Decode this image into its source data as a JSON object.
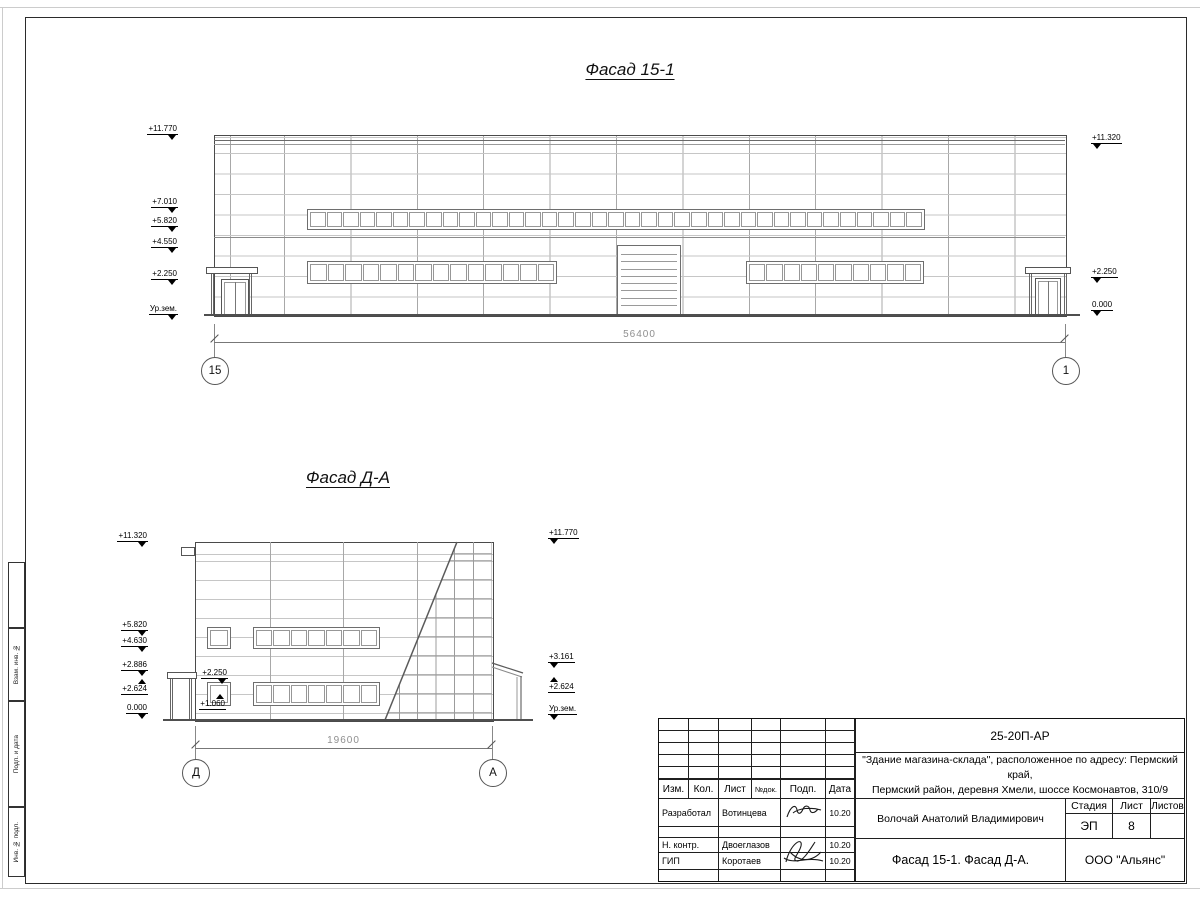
{
  "drawing": {
    "facade1": {
      "title": "Фасад 15-1",
      "dimension": "56400",
      "axis_left": "15",
      "axis_right": "1",
      "elevations_left": [
        "+11.770",
        "+7.010",
        "+5.820",
        "+4.550",
        "+2.250",
        "Ур.зем."
      ],
      "elevations_right": [
        "+11.320",
        "+2.250",
        "0.000"
      ],
      "bands": {
        "upper_panes": 37,
        "lower_left_panes": 14,
        "lower_right_panes": 10
      },
      "gate_slats": 9
    },
    "facade2": {
      "title": "Фасад Д-А",
      "dimension": "19600",
      "axis_left": "Д",
      "axis_right": "А",
      "elevations_left": [
        "+11.320",
        "+5.820",
        "+4.630",
        "+2.886",
        "+2.624",
        "0.000"
      ],
      "elevations_right": [
        "+11.770",
        "+3.161",
        "+2.624",
        "Ур.зем."
      ],
      "window_marks": [
        "+2.250",
        "+1.060"
      ],
      "bands": {
        "middle_panes": 7,
        "lower_panes": 7
      }
    }
  },
  "side_stamp": {
    "labels": [
      "Взам. инв. №",
      "Подп. и дата",
      "Инв. № подл."
    ]
  },
  "title_block": {
    "code": "25-20П-АР",
    "project_line1": "\"Здание магазина-склада\", расположенное по адресу: Пермский край,",
    "project_line2": "Пермский район, деревня Хмели, шоссе Космонавтов, 310/9",
    "person": "Волочай Анатолий Владимирович",
    "doc_title": "Фасад 15-1. Фасад Д-А.",
    "org": "ООО \"Альянс\"",
    "stage_label": "Стадия",
    "sheet_label": "Лист",
    "sheets_label": "Листов",
    "stage": "ЭП",
    "sheet_no": "8",
    "header": [
      "Изм.",
      "Кол.",
      "Лист",
      "№док.",
      "Подп.",
      "Дата"
    ],
    "rows": [
      {
        "role": "Разработал",
        "name": "Вотинцева",
        "date": "10.20"
      },
      {
        "role": "Н. контр.",
        "name": "Двоеглазов",
        "date": "10.20"
      },
      {
        "role": "ГИП",
        "name": "Коротаев",
        "date": "10.20"
      }
    ]
  }
}
